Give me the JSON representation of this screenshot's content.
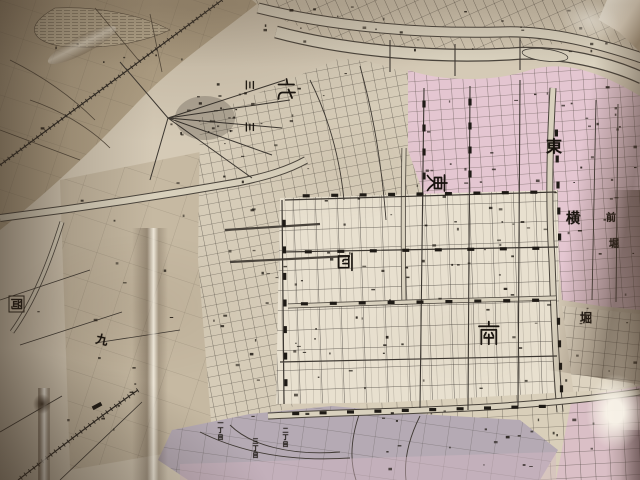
{
  "image": {
    "type": "photograph",
    "subject": "Folded antique Japanese city street map with ward districts, canals and rivers",
    "note": "Large ward kanji labels; north/east/west labels rotated 90 degrees on the map"
  },
  "palette": {
    "paper": "#d5cab6",
    "rural_paper": "#b2a287",
    "pink_district": "#e4c6d1",
    "purple_district": "#b5aab4",
    "south_paper": "#e8e0cf",
    "ink": "#3c3630",
    "mark_ink": "#221d17",
    "crease_highlight": "#f4efe2",
    "fold_shadow": "#5e4a36"
  },
  "districts": {
    "north": {
      "label": "北"
    },
    "east": {
      "label": "東"
    },
    "west": {
      "label": "西"
    },
    "south": {
      "label": "南"
    }
  },
  "labels": {
    "canal_char_1": "東",
    "canal_char_2": "横",
    "canal_char_3": "堀",
    "boxed_station": "岡",
    "numeral_nine": "九",
    "numeral_three_a": "三",
    "numeral_three_b": "三",
    "edge_char_1": "前",
    "edge_char_2": "堀",
    "chome_1": "一丁目",
    "chome_2": "二丁目",
    "chome_3": "三丁目"
  },
  "texture_glyphs": "町筋橋通丁目"
}
